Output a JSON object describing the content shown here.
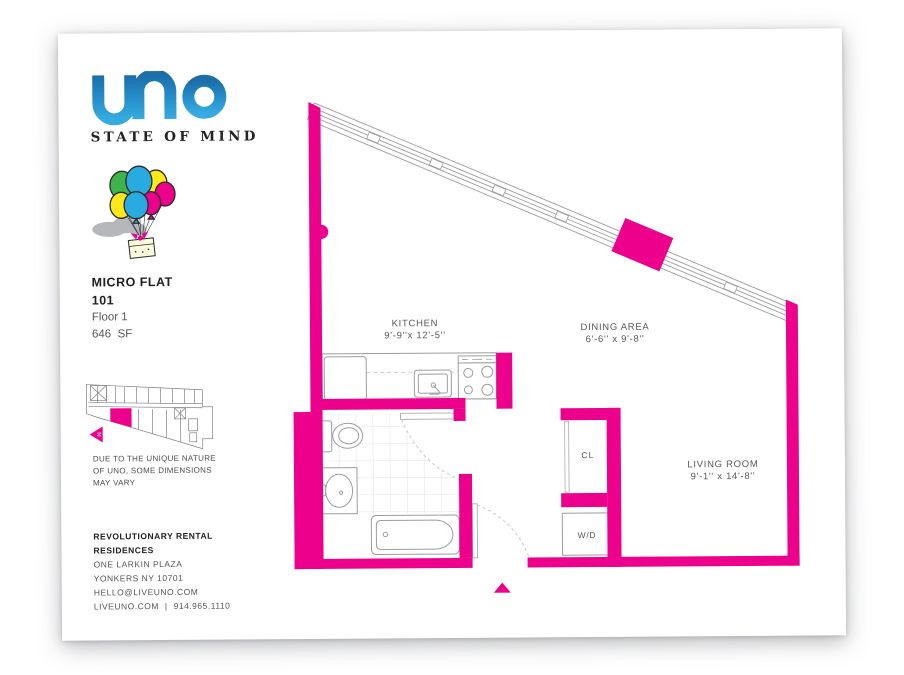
{
  "brand": {
    "logo_text": "uno",
    "tagline": "STATE OF MIND",
    "logo_blue_top": "#1B6EA8",
    "logo_blue_bottom": "#36ABE0"
  },
  "illustration": {
    "name": "balloons-lifting-gift-box",
    "balloon_green": "#3DB54A",
    "balloon_blue": "#29ABE2",
    "balloon_yellow": "#FFE81A",
    "balloon_magenta": "#EC008C",
    "cloud_gray": "#B5B7BA"
  },
  "unit": {
    "type": "MICRO FLAT",
    "number": "101",
    "floor": "Floor 1",
    "area": "646  SF"
  },
  "keyplan": {
    "north_label": "N",
    "highlight_color": "#EC008C"
  },
  "disclaimer": {
    "line1": "DUE TO THE UNIQUE NATURE",
    "line2": "OF UNO, SOME DIMENSIONS",
    "line3": "MAY VARY"
  },
  "contact": {
    "name_line1": "REVOLUTIONARY RENTAL",
    "name_line2": "RESIDENCES",
    "address1": "ONE LARKIN PLAZA",
    "address2": "YONKERS NY 10701",
    "email": "HELLO@LIVEUNO.COM",
    "website": "LIVEUNO.COM",
    "separator": "|",
    "phone": "914.965.1110"
  },
  "floorplan": {
    "wall_color": "#EC008C",
    "line_gray": "#9B9DA0",
    "tile_gray": "#DADBDC",
    "rooms": [
      {
        "name": "KITCHEN",
        "dims": "9'-9''x 12'-5''"
      },
      {
        "name": "DINING AREA",
        "dims": "6'-6'' x 9'-8''"
      },
      {
        "name": "LIVING ROOM",
        "dims": "9'-1'' x 14'-8''"
      }
    ],
    "fixtures": {
      "closet": "CL",
      "washer_dryer": "W/D"
    }
  }
}
